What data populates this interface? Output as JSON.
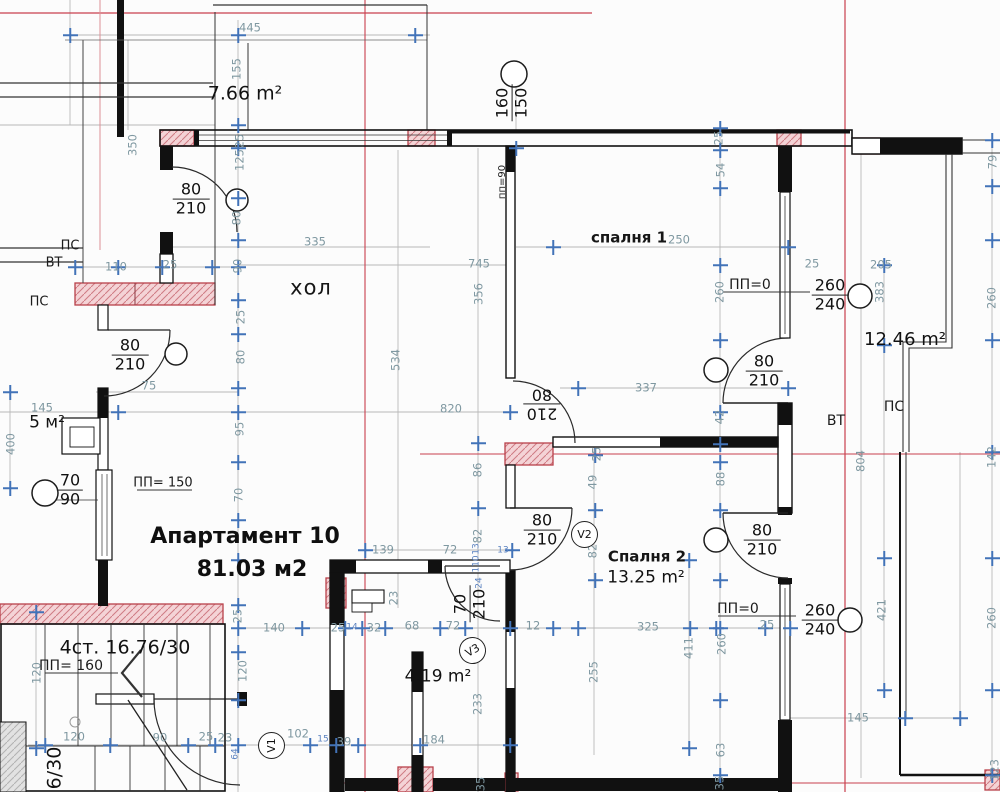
{
  "title": "Апартамент 10 — архитектурен план 81.03 м2",
  "drawing_type": "architectural floor plan",
  "colors": {
    "wall": "#1a1a1a",
    "pink_fill": "#f4d3d6",
    "pink_stroke": "#b8404a",
    "red_line": "#c9404e",
    "dim_text": "#7f98a1",
    "small_dim_text": "#5b82c0",
    "tick_blue": "#4273b8"
  },
  "apartment": {
    "name": "Апартамент 10",
    "total_area": "81.03  м2"
  },
  "rooms": [
    {
      "name": "хол"
    },
    {
      "name": "спалня 1"
    },
    {
      "name": "Спалня 2",
      "area": "13.25 m²"
    },
    {
      "name": "терраса",
      "area": "7.66 m²"
    },
    {
      "name": "терраса 2",
      "area": "12.46 m²"
    },
    {
      "name": "баня",
      "area": "4.19 m²"
    },
    {
      "name": "килер",
      "area": "5 м²"
    },
    {
      "name": "стълбище",
      "label": "4ст. 16.76/30"
    }
  ],
  "texts": [
    {
      "t": "7.66 m²",
      "x": 245,
      "y": 94,
      "s": "area",
      "fs": 19,
      "n": "room-area-terrace"
    },
    {
      "t": "хол",
      "x": 311,
      "y": 288,
      "s": "room",
      "n": "room-label-hall"
    },
    {
      "t": "спалня 1",
      "x": 629,
      "y": 238,
      "s": "rm2",
      "n": "room-label-bedroom1"
    },
    {
      "t": "Спалня 2",
      "x": 647,
      "y": 557,
      "s": "rm2",
      "n": "room-label-bedroom2"
    },
    {
      "t": "13.25 m²",
      "x": 646,
      "y": 578,
      "s": "area",
      "fs": 17,
      "n": "room-area-bedroom2"
    },
    {
      "t": "12.46 m²",
      "x": 905,
      "y": 340,
      "s": "area",
      "fs": 18,
      "n": "room-area-terrace2"
    },
    {
      "t": "4.19 m²",
      "x": 438,
      "y": 677,
      "s": "area",
      "fs": 17,
      "n": "room-area-bath"
    },
    {
      "t": "5 м²",
      "x": 47,
      "y": 423,
      "s": "area",
      "fs": 17,
      "n": "room-area-closet"
    },
    {
      "t": "Апартамент 10",
      "x": 245,
      "y": 537,
      "s": "big",
      "n": "apartment-name"
    },
    {
      "t": "81.03  м2",
      "x": 252,
      "y": 570,
      "s": "big",
      "n": "apartment-area"
    },
    {
      "t": "4ст. 16.76/30",
      "x": 125,
      "y": 648,
      "s": "area",
      "fs": 19,
      "n": "staircase-label"
    },
    {
      "t": "ПП= 160",
      "x": 71,
      "y": 666,
      "s": "b",
      "n": "parapet-160"
    },
    {
      "t": "ПП= 150",
      "x": 163,
      "y": 483,
      "s": "b",
      "fs": 13,
      "n": "parapet-150"
    },
    {
      "t": "ПП=0",
      "x": 750,
      "y": 285,
      "s": "b",
      "n": "parapet-0-top"
    },
    {
      "t": "ПП=0",
      "x": 738,
      "y": 609,
      "s": "b",
      "n": "parapet-0-bottom"
    },
    {
      "t": "ПС",
      "x": 70,
      "y": 246,
      "s": "b",
      "fs": 13
    },
    {
      "t": "ВТ",
      "x": 54,
      "y": 263,
      "s": "b",
      "fs": 13
    },
    {
      "t": "ПС",
      "x": 39,
      "y": 302,
      "s": "b",
      "fs": 13
    },
    {
      "t": "ВТ",
      "x": 836,
      "y": 421,
      "s": "b"
    },
    {
      "t": "ПС",
      "x": 894,
      "y": 407,
      "s": "b"
    },
    {
      "t": "пп=90",
      "x": 503,
      "y": 182,
      "s": "b",
      "fs": 10,
      "r": -90
    },
    {
      "t": "6/30",
      "x": 55,
      "y": 768,
      "s": "area",
      "fs": 19,
      "r": -90,
      "n": "staircase-label-cut"
    },
    {
      "t": "445",
      "x": 250,
      "y": 28,
      "s": "d"
    },
    {
      "t": "110",
      "x": 116,
      "y": 267,
      "s": "d"
    },
    {
      "t": "25",
      "x": 170,
      "y": 265,
      "s": "d"
    },
    {
      "t": "335",
      "x": 315,
      "y": 242,
      "s": "d"
    },
    {
      "t": "745",
      "x": 479,
      "y": 264,
      "s": "d"
    },
    {
      "t": "250",
      "x": 679,
      "y": 240,
      "s": "d"
    },
    {
      "t": "205",
      "x": 881,
      "y": 265,
      "s": "d"
    },
    {
      "t": "25",
      "x": 812,
      "y": 264,
      "s": "d"
    },
    {
      "t": "820",
      "x": 451,
      "y": 409,
      "s": "d"
    },
    {
      "t": "337",
      "x": 646,
      "y": 388,
      "s": "d"
    },
    {
      "t": "75",
      "x": 149,
      "y": 386,
      "s": "d"
    },
    {
      "t": "145",
      "x": 42,
      "y": 408,
      "s": "d"
    },
    {
      "t": "139",
      "x": 383,
      "y": 550,
      "s": "d"
    },
    {
      "t": "72",
      "x": 450,
      "y": 550,
      "s": "d"
    },
    {
      "t": "13",
      "x": 503,
      "y": 551,
      "s": "t9"
    },
    {
      "t": "140",
      "x": 274,
      "y": 628,
      "s": "d"
    },
    {
      "t": "25",
      "x": 338,
      "y": 628,
      "s": "d"
    },
    {
      "t": "14",
      "x": 352,
      "y": 628,
      "s": "t9"
    },
    {
      "t": "32",
      "x": 374,
      "y": 628,
      "s": "d"
    },
    {
      "t": "68",
      "x": 412,
      "y": 626,
      "s": "d"
    },
    {
      "t": "72",
      "x": 453,
      "y": 626,
      "s": "d"
    },
    {
      "t": "12",
      "x": 533,
      "y": 626,
      "s": "d"
    },
    {
      "t": "325",
      "x": 648,
      "y": 627,
      "s": "d"
    },
    {
      "t": "25",
      "x": 767,
      "y": 625,
      "s": "d"
    },
    {
      "t": "145",
      "x": 858,
      "y": 718,
      "s": "d"
    },
    {
      "t": "184",
      "x": 434,
      "y": 740,
      "s": "d"
    },
    {
      "t": "120",
      "x": 74,
      "y": 737,
      "s": "d"
    },
    {
      "t": "90",
      "x": 160,
      "y": 738,
      "s": "d"
    },
    {
      "t": "25",
      "x": 206,
      "y": 737,
      "s": "d"
    },
    {
      "t": "23",
      "x": 225,
      "y": 738,
      "s": "d"
    },
    {
      "t": "102",
      "x": 298,
      "y": 734,
      "s": "d"
    },
    {
      "t": "15",
      "x": 323,
      "y": 740,
      "s": "t9"
    },
    {
      "t": "39",
      "x": 344,
      "y": 742,
      "s": "d"
    },
    {
      "t": "64",
      "x": 236,
      "y": 754,
      "s": "t9",
      "r": -90
    },
    {
      "t": "155",
      "x": 237,
      "y": 69,
      "s": "d",
      "r": -90
    },
    {
      "t": "350",
      "x": 133,
      "y": 145,
      "s": "d",
      "r": -90
    },
    {
      "t": "25",
      "x": 240,
      "y": 141,
      "s": "d",
      "r": -90
    },
    {
      "t": "125",
      "x": 240,
      "y": 160,
      "s": "d",
      "r": -90
    },
    {
      "t": "80",
      "x": 237,
      "y": 218,
      "s": "d",
      "r": -90
    },
    {
      "t": "90",
      "x": 238,
      "y": 266,
      "s": "d",
      "r": -90
    },
    {
      "t": "25",
      "x": 241,
      "y": 317,
      "s": "d",
      "r": -90
    },
    {
      "t": "80",
      "x": 241,
      "y": 357,
      "s": "d",
      "r": -90
    },
    {
      "t": "95",
      "x": 240,
      "y": 429,
      "s": "d",
      "r": -90
    },
    {
      "t": "70",
      "x": 239,
      "y": 495,
      "s": "d",
      "r": -90
    },
    {
      "t": "400",
      "x": 11,
      "y": 444,
      "s": "d",
      "r": -90
    },
    {
      "t": "120",
      "x": 37,
      "y": 673,
      "s": "d",
      "r": -90
    },
    {
      "t": "120",
      "x": 243,
      "y": 671,
      "s": "d",
      "r": -90
    },
    {
      "t": "25",
      "x": 238,
      "y": 616,
      "s": "d",
      "r": -90
    },
    {
      "t": "356",
      "x": 479,
      "y": 294,
      "s": "d",
      "r": -90
    },
    {
      "t": "534",
      "x": 396,
      "y": 360,
      "s": "d",
      "r": -90
    },
    {
      "t": "86",
      "x": 478,
      "y": 470,
      "s": "d",
      "r": -90
    },
    {
      "t": "82",
      "x": 478,
      "y": 536,
      "s": "d",
      "r": -90
    },
    {
      "t": "110",
      "x": 477,
      "y": 564,
      "s": "t9",
      "r": -90
    },
    {
      "t": "24",
      "x": 480,
      "y": 583,
      "s": "t9",
      "r": -90
    },
    {
      "t": "13",
      "x": 477,
      "y": 549,
      "s": "t9",
      "r": -90
    },
    {
      "t": "23",
      "x": 394,
      "y": 598,
      "s": "d",
      "r": -90
    },
    {
      "t": "233",
      "x": 478,
      "y": 704,
      "s": "d",
      "r": -90
    },
    {
      "t": "35",
      "x": 481,
      "y": 784,
      "s": "d",
      "r": -90
    },
    {
      "t": "25",
      "x": 719,
      "y": 138,
      "s": "d",
      "r": -90
    },
    {
      "t": "54",
      "x": 721,
      "y": 170,
      "s": "d",
      "r": -90
    },
    {
      "t": "260",
      "x": 720,
      "y": 292,
      "s": "d",
      "r": -90
    },
    {
      "t": "42",
      "x": 720,
      "y": 417,
      "s": "d",
      "r": -90
    },
    {
      "t": "88",
      "x": 721,
      "y": 479,
      "s": "d",
      "r": -90
    },
    {
      "t": "260",
      "x": 722,
      "y": 644,
      "s": "d",
      "r": -90
    },
    {
      "t": "63",
      "x": 721,
      "y": 750,
      "s": "d",
      "r": -90
    },
    {
      "t": "35",
      "x": 720,
      "y": 783,
      "s": "d",
      "r": -90
    },
    {
      "t": "79",
      "x": 993,
      "y": 162,
      "s": "d",
      "r": -90
    },
    {
      "t": "260",
      "x": 992,
      "y": 298,
      "s": "d",
      "r": -90
    },
    {
      "t": "142",
      "x": 992,
      "y": 457,
      "s": "d",
      "r": -90
    },
    {
      "t": "260",
      "x": 992,
      "y": 618,
      "s": "d",
      "r": -90
    },
    {
      "t": "123",
      "x": 995,
      "y": 770,
      "s": "d",
      "r": -90
    },
    {
      "t": "383",
      "x": 880,
      "y": 292,
      "s": "d",
      "r": -90
    },
    {
      "t": "421",
      "x": 882,
      "y": 610,
      "s": "d",
      "r": -90
    },
    {
      "t": "804",
      "x": 861,
      "y": 461,
      "s": "d",
      "r": -90
    },
    {
      "t": "49",
      "x": 593,
      "y": 482,
      "s": "d",
      "r": -90
    },
    {
      "t": "25",
      "x": 597,
      "y": 454,
      "s": "d",
      "r": -90
    },
    {
      "t": "82",
      "x": 593,
      "y": 551,
      "s": "d",
      "r": -90
    },
    {
      "t": "255",
      "x": 594,
      "y": 672,
      "s": "d",
      "r": -90
    },
    {
      "t": "411",
      "x": 689,
      "y": 648,
      "s": "d",
      "r": -90
    }
  ],
  "door_window_marks": [
    {
      "top": "80",
      "bot": "210",
      "x": 191,
      "y": 199,
      "n": "door-mark-hall-entry"
    },
    {
      "top": "80",
      "bot": "210",
      "x": 130,
      "y": 355,
      "n": "door-mark-left"
    },
    {
      "top": "80",
      "bot": "210",
      "x": 542,
      "y": 530,
      "n": "door-mark-bedroom2"
    },
    {
      "top": "80",
      "bot": "210",
      "x": 764,
      "y": 371,
      "n": "door-mark-bedroom1-terrace"
    },
    {
      "top": "80",
      "bot": "210",
      "x": 762,
      "y": 540,
      "n": "door-mark-bedroom2-terrace"
    },
    {
      "top": "70",
      "bot": "90",
      "x": 70,
      "y": 490,
      "n": "window-mark-70-90"
    },
    {
      "top": "260",
      "bot": "240",
      "x": 830,
      "y": 295,
      "n": "window-mark-260-240-top"
    },
    {
      "top": "260",
      "bot": "240",
      "x": 820,
      "y": 620,
      "n": "window-mark-260-240-bottom"
    },
    {
      "top": "160",
      "bot": "150",
      "x": 512,
      "y": 103,
      "r": -90,
      "n": "window-mark-160-150"
    },
    {
      "top": "210",
      "bot": "80",
      "x": 542,
      "y": 404,
      "r": 180,
      "n": "door-mark-hall-bedroom"
    },
    {
      "top": "70",
      "bot": "210",
      "x": 470,
      "y": 604,
      "r": -90,
      "n": "door-mark-bath"
    }
  ],
  "vent_marks": [
    {
      "t": "V2",
      "x": 584,
      "y": 534,
      "r": 0
    },
    {
      "t": "V3",
      "x": 472,
      "y": 650,
      "r": -30
    },
    {
      "t": "V1",
      "x": 271,
      "y": 745,
      "r": -90
    }
  ],
  "ticks": [
    [
      238,
      35
    ],
    [
      238,
      125
    ],
    [
      238,
      148
    ],
    [
      238,
      198
    ],
    [
      238,
      240
    ],
    [
      238,
      267
    ],
    [
      238,
      300
    ],
    [
      238,
      334
    ],
    [
      238,
      388
    ],
    [
      238,
      412
    ],
    [
      238,
      462
    ],
    [
      238,
      520
    ],
    [
      238,
      560
    ],
    [
      238,
      605
    ],
    [
      238,
      628
    ],
    [
      238,
      652
    ],
    [
      238,
      700
    ],
    [
      238,
      745
    ],
    [
      720,
      128
    ],
    [
      720,
      150
    ],
    [
      720,
      188
    ],
    [
      720,
      265
    ],
    [
      720,
      340
    ],
    [
      720,
      412
    ],
    [
      720,
      444
    ],
    [
      720,
      462
    ],
    [
      720,
      510
    ],
    [
      720,
      580
    ],
    [
      720,
      628
    ],
    [
      720,
      700
    ],
    [
      720,
      775
    ],
    [
      992,
      140
    ],
    [
      992,
      186
    ],
    [
      992,
      240
    ],
    [
      992,
      340
    ],
    [
      992,
      452
    ],
    [
      992,
      558
    ],
    [
      992,
      690
    ],
    [
      992,
      775
    ],
    [
      75,
      267
    ],
    [
      118,
      267
    ],
    [
      162,
      267
    ],
    [
      212,
      267
    ],
    [
      302,
      628
    ],
    [
      345,
      628
    ],
    [
      362,
      628
    ],
    [
      385,
      628
    ],
    [
      440,
      628
    ],
    [
      465,
      628
    ],
    [
      510,
      628
    ],
    [
      553,
      628
    ],
    [
      578,
      628
    ],
    [
      690,
      628
    ],
    [
      716,
      628
    ],
    [
      765,
      628
    ],
    [
      790,
      628
    ],
    [
      45,
      745
    ],
    [
      110,
      745
    ],
    [
      188,
      745
    ],
    [
      215,
      745
    ],
    [
      310,
      745
    ],
    [
      336,
      745
    ],
    [
      358,
      745
    ],
    [
      420,
      745
    ],
    [
      510,
      745
    ],
    [
      70,
      35
    ],
    [
      415,
      35
    ],
    [
      516,
      148
    ],
    [
      553,
      247
    ],
    [
      788,
      247
    ],
    [
      578,
      388
    ],
    [
      788,
      388
    ],
    [
      365,
      550
    ],
    [
      512,
      550
    ],
    [
      884,
      265
    ],
    [
      884,
      345
    ],
    [
      884,
      558
    ],
    [
      884,
      690
    ],
    [
      689,
      560
    ],
    [
      689,
      748
    ],
    [
      10,
      392
    ],
    [
      10,
      488
    ],
    [
      36,
      612
    ],
    [
      36,
      748
    ],
    [
      118,
      412
    ],
    [
      510,
      412
    ],
    [
      595,
      455
    ],
    [
      595,
      510
    ],
    [
      595,
      580
    ],
    [
      478,
      443
    ],
    [
      478,
      508
    ],
    [
      905,
      718
    ],
    [
      960,
      718
    ]
  ]
}
